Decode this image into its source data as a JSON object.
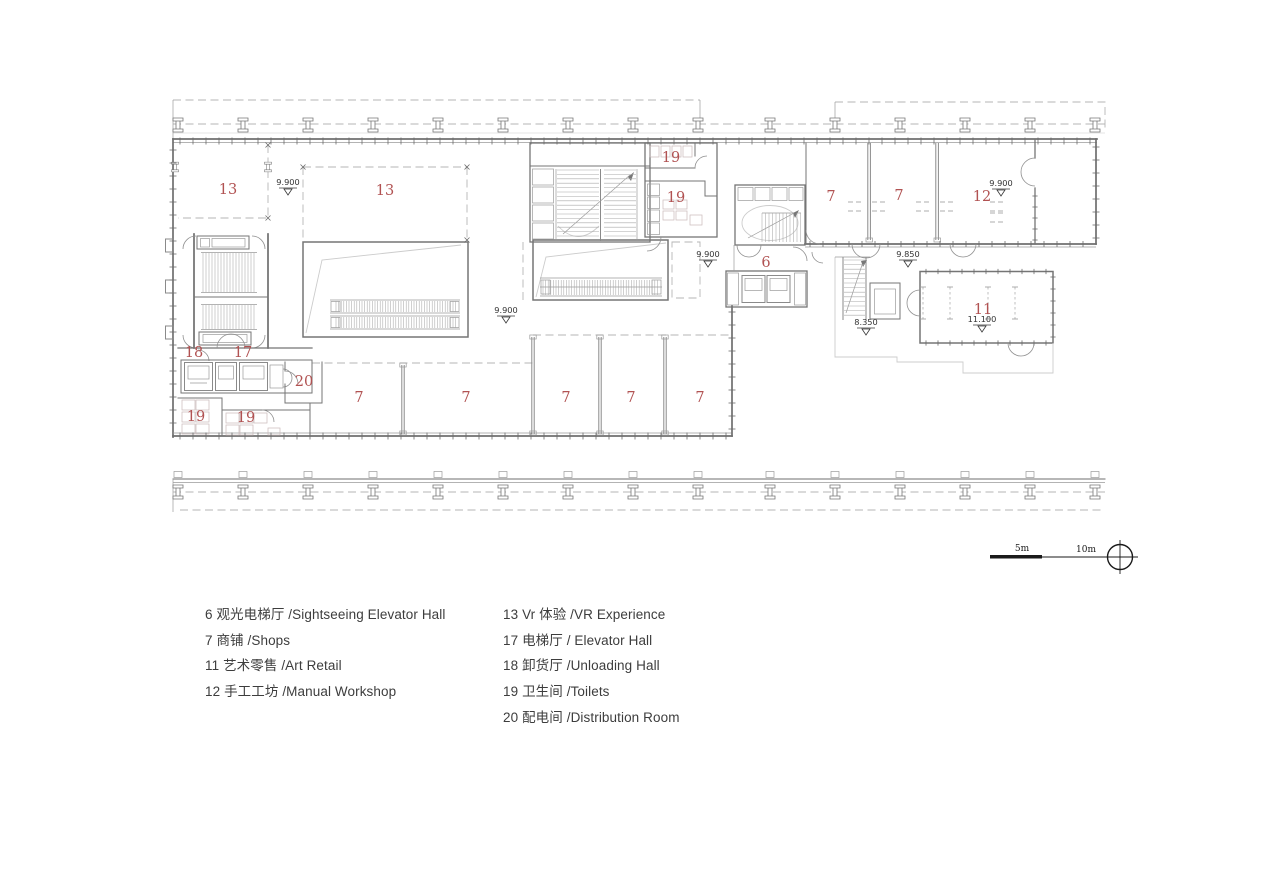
{
  "plan": {
    "room_labels": [
      {
        "t": "13",
        "x": 228,
        "y": 190
      },
      {
        "t": "13",
        "x": 385,
        "y": 191
      },
      {
        "t": "19",
        "x": 671,
        "y": 158
      },
      {
        "t": "19",
        "x": 676,
        "y": 198
      },
      {
        "t": "7",
        "x": 831,
        "y": 197
      },
      {
        "t": "7",
        "x": 899,
        "y": 196
      },
      {
        "t": "12",
        "x": 982,
        "y": 197
      },
      {
        "t": "6",
        "x": 766,
        "y": 263
      },
      {
        "t": "11",
        "x": 983,
        "y": 310
      },
      {
        "t": "18",
        "x": 194,
        "y": 353
      },
      {
        "t": "17",
        "x": 243,
        "y": 353
      },
      {
        "t": "20",
        "x": 304,
        "y": 382
      },
      {
        "t": "7",
        "x": 359,
        "y": 398
      },
      {
        "t": "7",
        "x": 466,
        "y": 398
      },
      {
        "t": "7",
        "x": 566,
        "y": 398
      },
      {
        "t": "7",
        "x": 631,
        "y": 398
      },
      {
        "t": "7",
        "x": 700,
        "y": 398
      },
      {
        "t": "19",
        "x": 196,
        "y": 417
      },
      {
        "t": "19",
        "x": 246,
        "y": 418
      }
    ],
    "elevation_markers": [
      {
        "v": "9.900",
        "x": 288,
        "y": 188
      },
      {
        "v": "9.900",
        "x": 1001,
        "y": 189
      },
      {
        "v": "9.900",
        "x": 708,
        "y": 260
      },
      {
        "v": "9.850",
        "x": 908,
        "y": 260
      },
      {
        "v": "9.900",
        "x": 506,
        "y": 316
      },
      {
        "v": "8.350",
        "x": 866,
        "y": 328
      },
      {
        "v": "11.100",
        "x": 982,
        "y": 325
      }
    ]
  },
  "legend": {
    "col1": [
      "6 观光电梯厅 /Sightseeing Elevator Hall",
      "7 商铺 /Shops",
      "11 艺术零售 /Art Retail",
      "12 手工工坊 /Manual Workshop"
    ],
    "col2": [
      "13 Vr 体验 /VR Experience",
      "17 电梯厅 / Elevator Hall",
      "18 卸货厅 /Unloading Hall",
      "19 卫生间 /Toilets",
      "20 配电间 /Distribution Room"
    ]
  },
  "scale_bar": {
    "label_5m": "5m",
    "label_10m": "10m"
  },
  "colors": {
    "room_label_red": "#b15252",
    "wall_gray": "#6f6f6f",
    "marker_text": "#333333",
    "drawing_black": "#1a1a1a",
    "background": "#ffffff"
  }
}
